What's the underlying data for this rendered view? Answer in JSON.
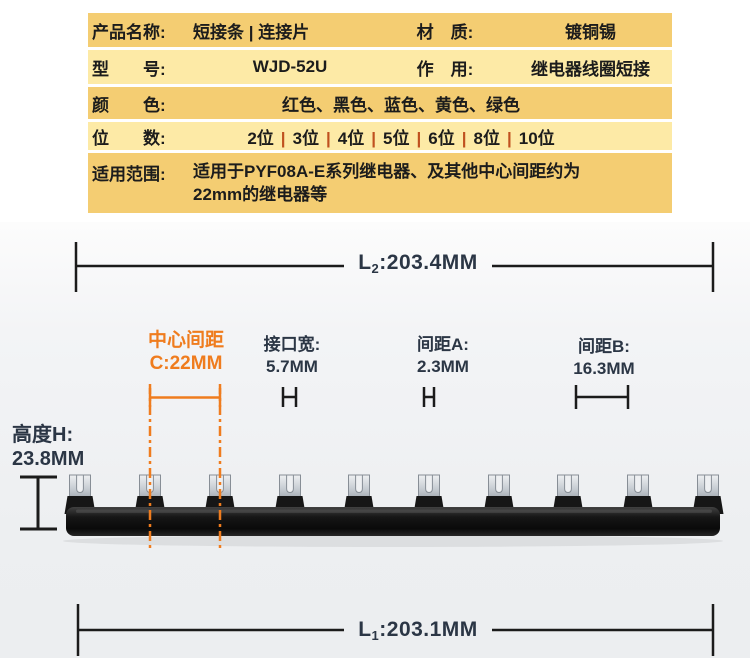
{
  "colors": {
    "row_amber": "#f4cd72",
    "row_light": "#fdeaa6",
    "pipe": "#c0511f",
    "orange": "#ef7c1e",
    "navy": "#2b3645",
    "line": "#1b1b1b"
  },
  "table": {
    "product": {
      "label": "产品名称:",
      "value": "短接条 | 连接片",
      "label2": "材　质:",
      "value2": "镀铜锡"
    },
    "model": {
      "label": "型　　号:",
      "value": "WJD-52U",
      "label2": "作　用:",
      "value2": "继电器线圈短接"
    },
    "color": {
      "label": "颜　　色:",
      "value": "红色、黑色、蓝色、黄色、绿色"
    },
    "positions": {
      "label": "位　　数:",
      "separator": "|",
      "items": [
        "2位",
        "3位",
        "4位",
        "5位",
        "6位",
        "8位",
        "10位"
      ]
    },
    "scope": {
      "label": "适用范围:",
      "line1": "适用于PYF08A-E系列继电器、及其他中心间距约为",
      "line2": "22mm的继电器等"
    }
  },
  "diagram": {
    "dim_l2": {
      "prefix": "L",
      "sub": "2",
      "rest": ":203.4MM"
    },
    "dim_l1": {
      "prefix": "L",
      "sub": "1",
      "rest": ":203.1MM"
    },
    "center_spacing": {
      "line1": "中心间距",
      "line2": "C:22MM"
    },
    "interface_width": {
      "line1": "接口宽:",
      "line2": "5.7MM"
    },
    "gap_a": {
      "line1": "间距A:",
      "line2": "2.3MM"
    },
    "gap_b": {
      "line1": "间距B:",
      "line2": "16.3MM"
    },
    "height_h": {
      "line1": "高度H:",
      "line2": "23.8MM"
    }
  }
}
